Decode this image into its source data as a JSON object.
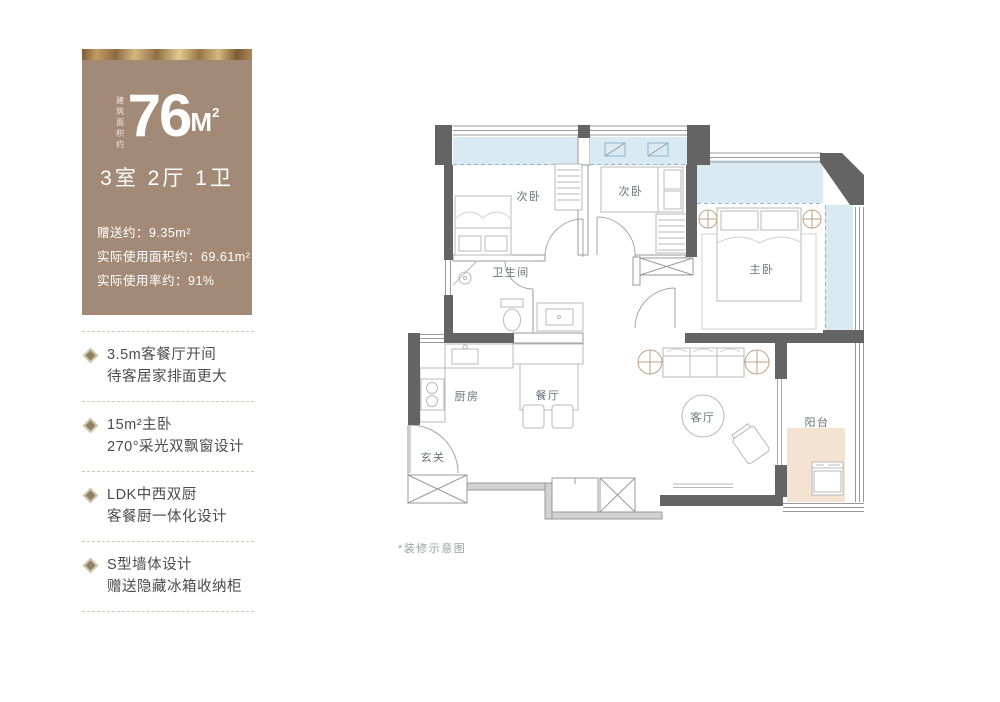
{
  "card": {
    "area_prefix_vertical": "建筑面积约",
    "area_number": "76",
    "area_unit": "M",
    "area_unit_exp": "2",
    "rooms_summary": "3室 2厅 1卫",
    "details": [
      "赠送约：9.35m²",
      "实际使用面积约：69.61m²",
      "实际使用率约：91%"
    ]
  },
  "features": [
    {
      "line1": "3.5m客餐厅开间",
      "line2": "待客居家排面更大"
    },
    {
      "line1": "15m²主卧",
      "line2": "270°采光双飘窗设计"
    },
    {
      "line1": "LDK中西双厨",
      "line2": "客餐厨一体化设计"
    },
    {
      "line1": "S型墙体设计",
      "line2": "赠送隐藏冰箱收纳柜"
    }
  ],
  "floorplan": {
    "labels": {
      "bedroom_left": "次卧",
      "bedroom_mid": "次卧",
      "master": "主卧",
      "bathroom": "卫生间",
      "kitchen": "厨房",
      "dining": "餐厅",
      "living": "客厅",
      "balcony": "阳台",
      "entry": "玄关"
    },
    "caption": "*装修示意图"
  },
  "colors": {
    "card_bg": "#a28a76",
    "window_blue": "#d9eaf3",
    "balcony_tan": "#f4e3d2",
    "wall_dark": "#646464"
  }
}
